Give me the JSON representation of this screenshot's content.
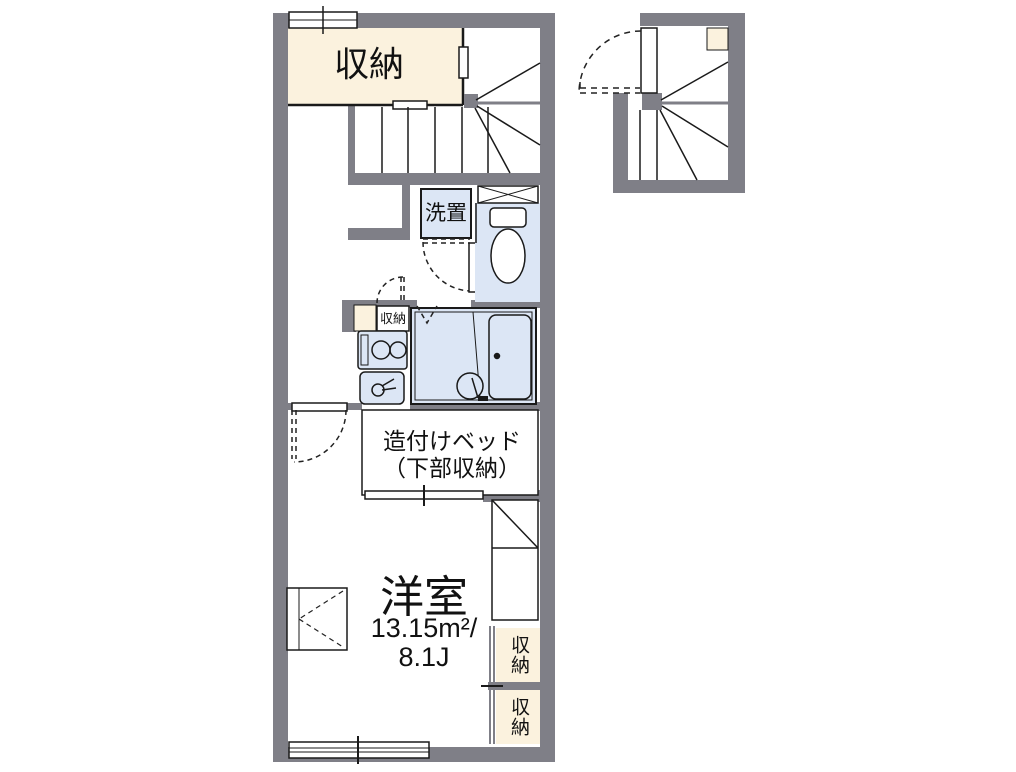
{
  "colors": {
    "wall": "#7f7f87",
    "cream": "#fbf2de",
    "blue": "#dce6f5",
    "line": "#1a1a1a",
    "bg": "#ffffff"
  },
  "labels": {
    "closet_top": "収納",
    "washer": "洗置",
    "closet_small": "収納",
    "bed_line1": "造付けベッド",
    "bed_line2": "（下部収納）",
    "room_name": "洋室",
    "room_area_line1": "13.15m²/",
    "room_area_line2": "8.1J",
    "closet_right_upper": "収納",
    "closet_right_lower": "収納"
  }
}
